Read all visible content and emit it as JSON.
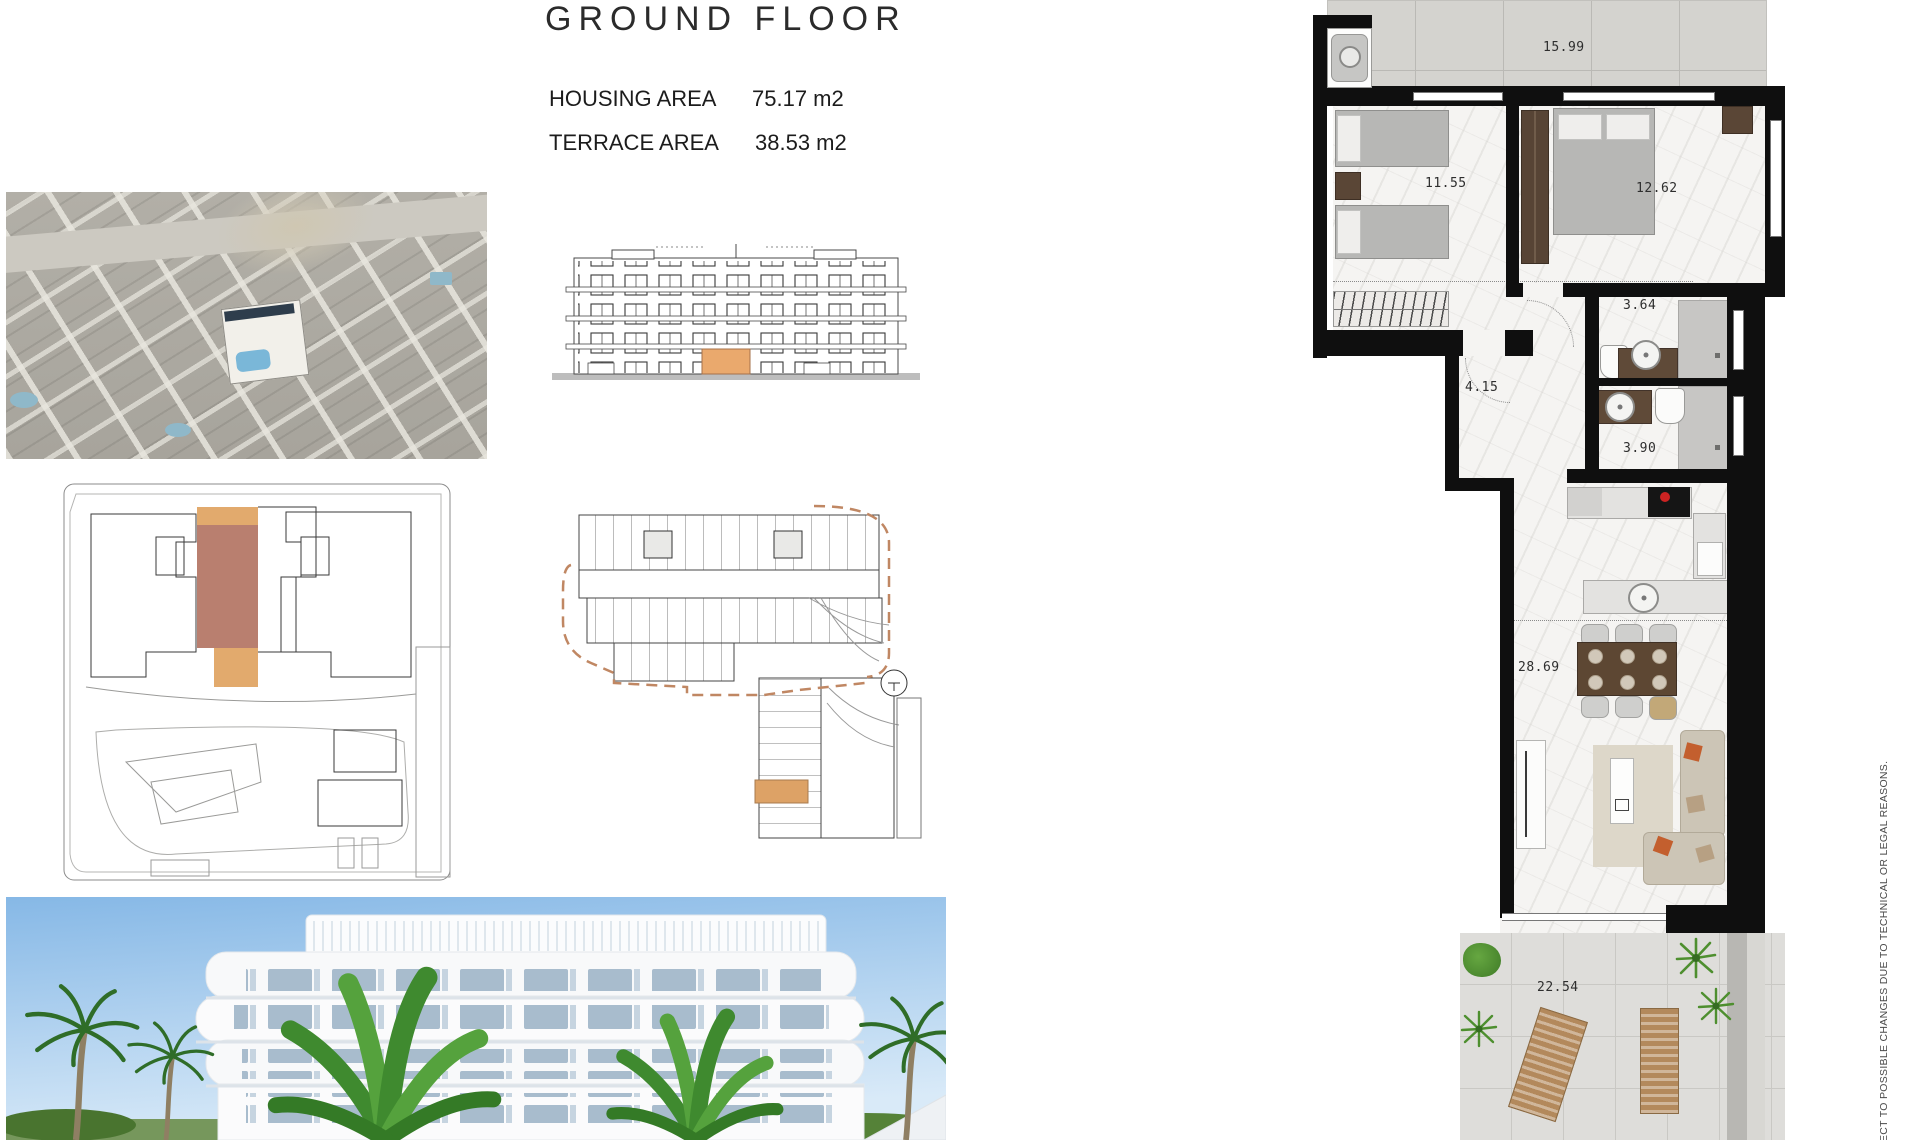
{
  "page": {
    "title": "GROUND FLOOR"
  },
  "areas": {
    "housing_label": "HOUSING AREA",
    "housing_value": "75.17 m2",
    "terrace_label": "TERRACE AREA",
    "terrace_value": "38.53 m2"
  },
  "unit_plan": {
    "labels": {
      "terrace_top": "15.99",
      "bedroom_small": "11.55",
      "bedroom_master": "12.62",
      "bathroom_1": "3.64",
      "hall": "4.15",
      "bathroom_2": "3.90",
      "living_kitchen": "28.69",
      "terrace_main": "22.54"
    }
  },
  "disclaimer": "ECT TO POSSIBLE CHANGES DUE TO TECHNICAL OR LEGAL REASONS.",
  "colors": {
    "highlight_tan": "#e2aa6d",
    "highlight_rose": "#b97f6f",
    "accent_orange": "#c35f2e",
    "pool_blue": "#7ab7d8",
    "wall_black": "#0f0f0f"
  }
}
